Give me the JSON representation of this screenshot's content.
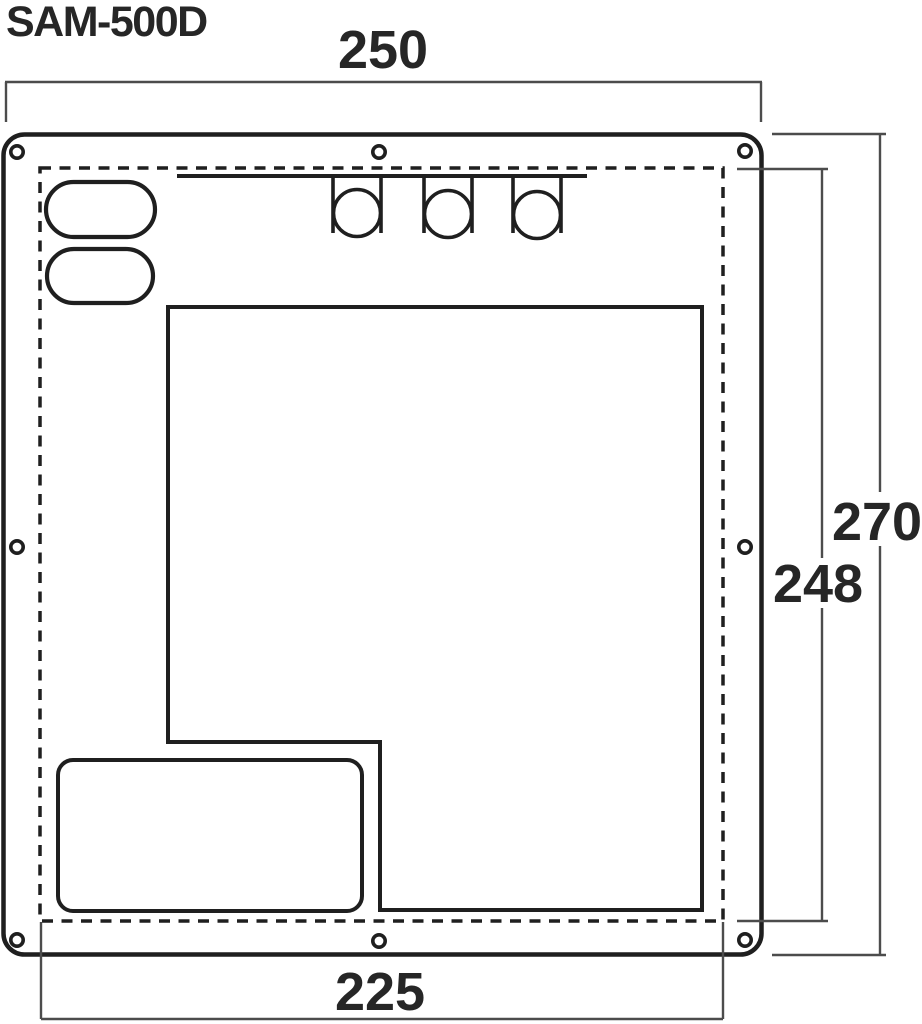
{
  "title": "SAM-500D",
  "dimensions": {
    "top_width": "250",
    "bottom_width": "225",
    "outer_height": "270",
    "inner_height": "248"
  },
  "colors": {
    "ink": "#1f1f1f",
    "dimension_lines": "#4c4c4c",
    "text": "#262626",
    "background": "#ffffff"
  }
}
